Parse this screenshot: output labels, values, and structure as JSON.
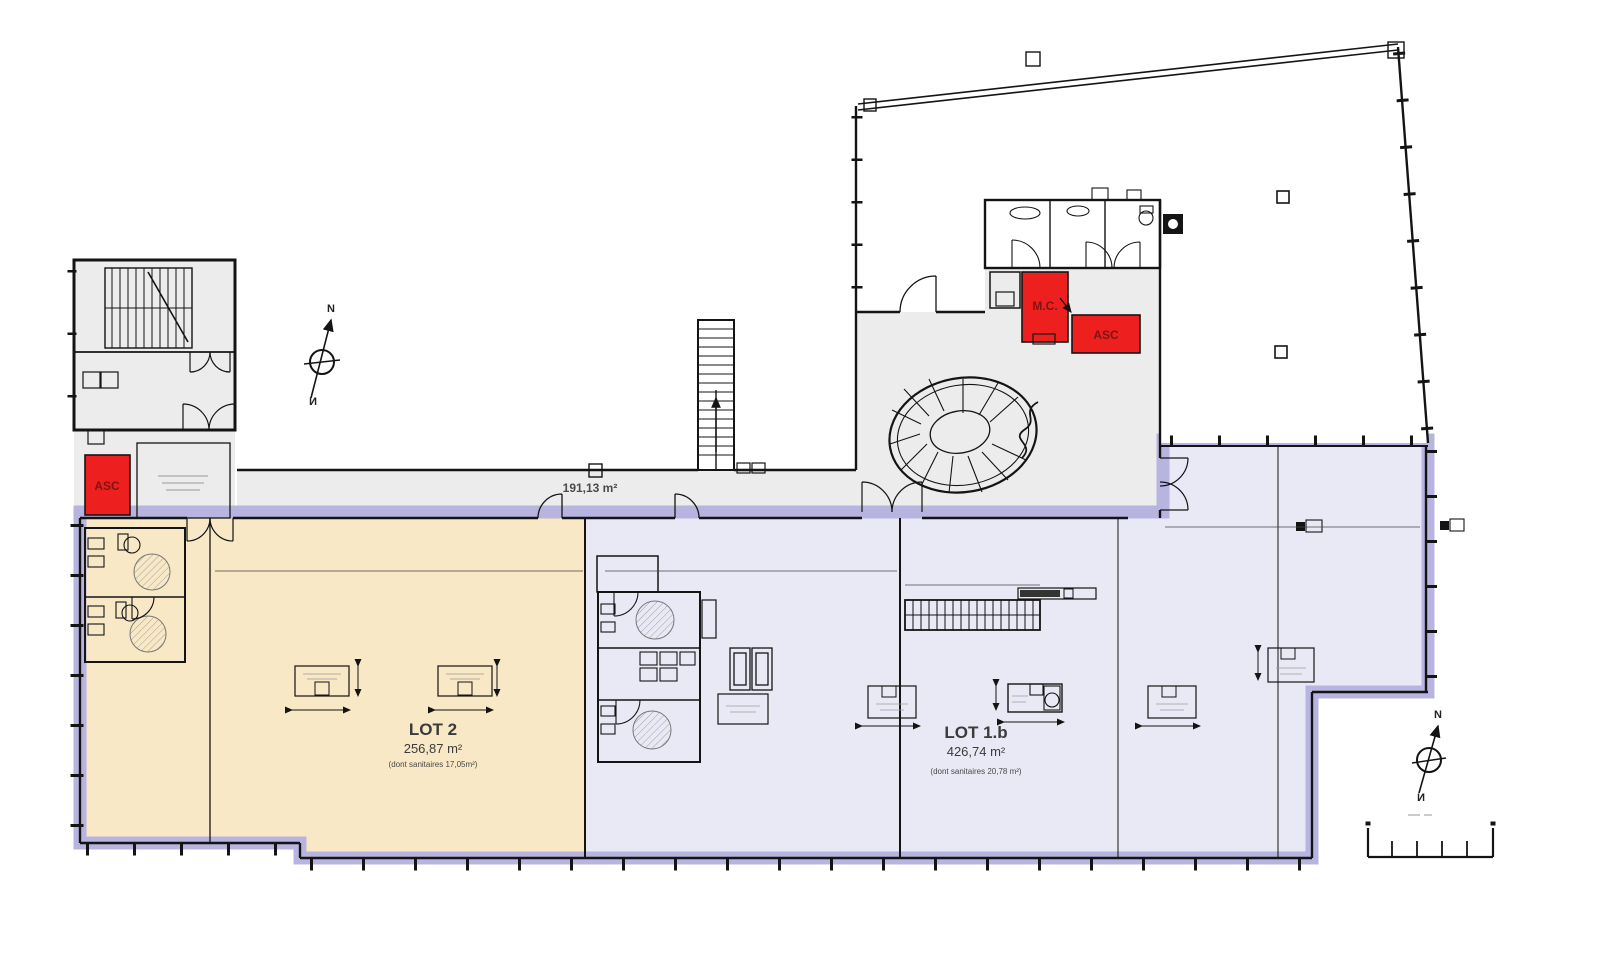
{
  "colors": {
    "highlight_band": "#b7b4e0",
    "lot1b_fill": "#e9e9f6",
    "lot2_fill": "#f8e8c5",
    "common_fill": "#ececec",
    "sanitary_base": "#e9e4d6",
    "wall": "#141414",
    "red_box": "#ee1f1f",
    "red_box_text": "#7e1414",
    "background": "#ffffff"
  },
  "plan": {
    "lots": [
      {
        "id": "lot2",
        "name": "LOT 2",
        "area": "256,87 m²",
        "note": "(dont sanitaires 17,05m²)"
      },
      {
        "id": "lot1b",
        "name": "LOT 1.b",
        "area": "426,74 m²",
        "note": "(dont sanitaires 20,78 m²)"
      }
    ],
    "circulation_area": "191,13 m²",
    "rooms": {
      "elevator": "ASC",
      "service_duct": "M.C."
    },
    "compass_label": "N"
  }
}
